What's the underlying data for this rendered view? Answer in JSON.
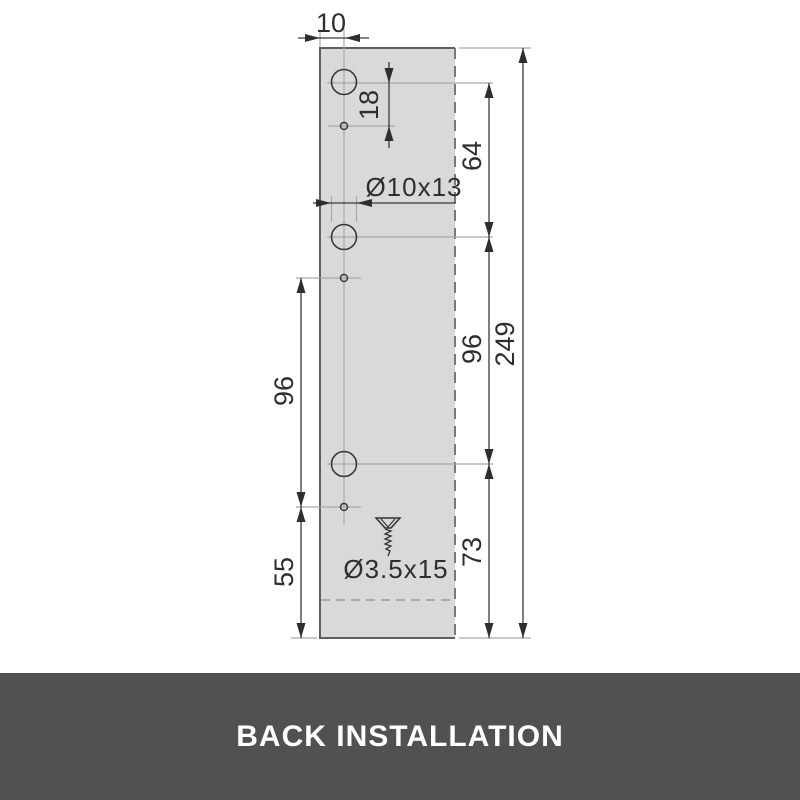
{
  "banner": {
    "label": "BACK INSTALLATION"
  },
  "dimensions": {
    "edge_to_hole_axis": "10",
    "large_to_small_hole": "18",
    "first_to_second_hole": "64",
    "second_to_third_hole_right": "96",
    "small_hole_spacing_left": "96",
    "third_hole_to_bottom": "73",
    "small_hole_to_bottom": "55",
    "overall_height": "249"
  },
  "callouts": {
    "large_hole": "Ø10x13",
    "screw": "Ø3.5x15"
  },
  "colors": {
    "banner_bg": "#515151",
    "banner_text": "#ffffff",
    "panel_fill": "#d9d9d9",
    "panel_outline": "#5f5f5f",
    "dimension_line": "#3a3a3a",
    "extension_line": "#a9a9a9",
    "label_text": "#2e2e2e"
  }
}
